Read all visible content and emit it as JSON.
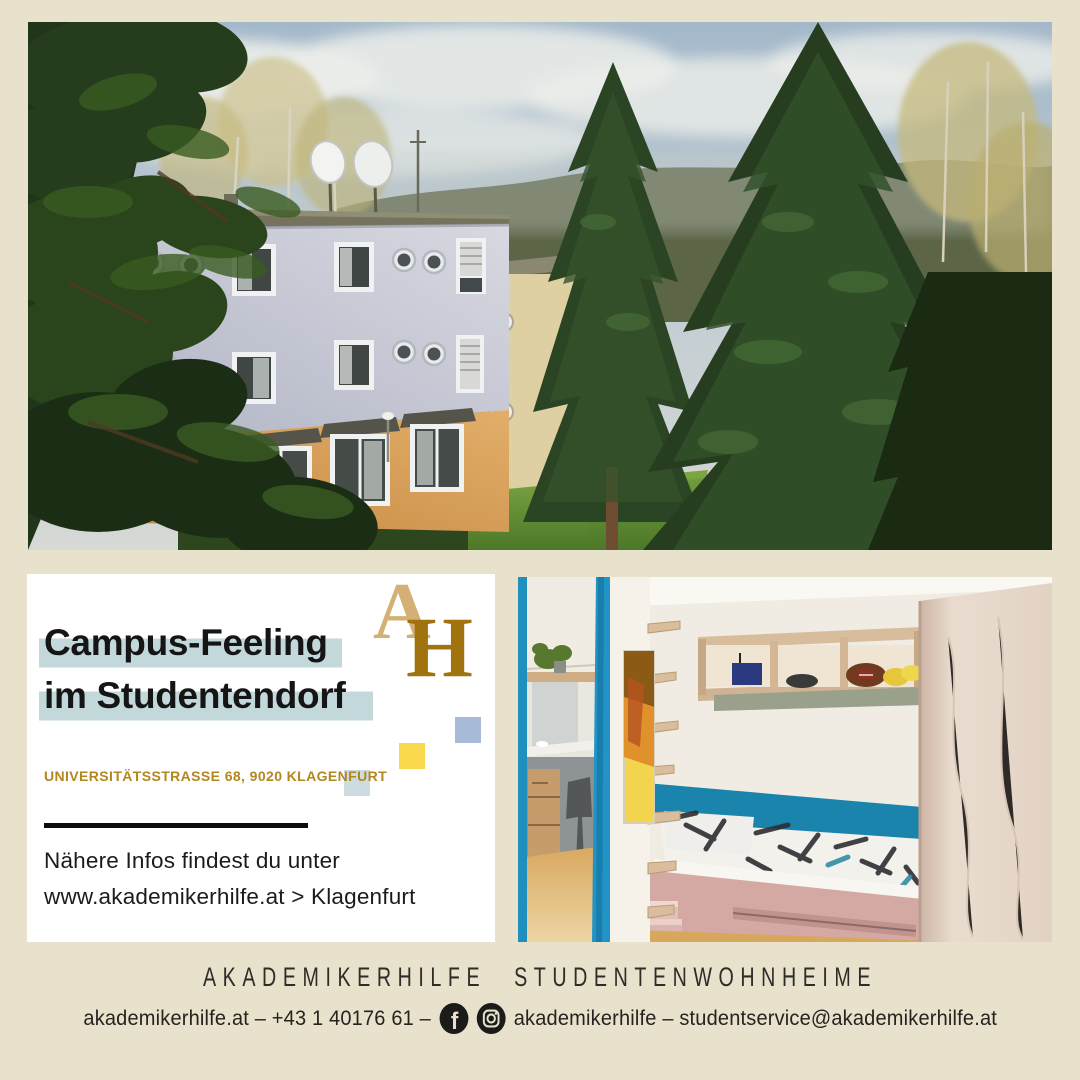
{
  "canvas": {
    "background_color": "#e8e1cc"
  },
  "top_photo": {
    "description": "Student dorm building with light grey upper floors, orange ground floor, round porthole windows, satellite dishes on roof, dark pine branches left, tall spruce trees right, lawn and wooded hill behind"
  },
  "card": {
    "headline_line1": "Campus-Feeling",
    "headline_line2": "im Studentendorf",
    "highlight_color": "#c3d8da",
    "address": "UNIVERSITÄTSSTRASSE 68, 9020 KLAGENFURT",
    "address_color": "#b3861f",
    "info_line1": "Nähere Infos findest du unter",
    "info_line2": "www.akademikerhilfe.at > Klagenfurt",
    "logo": {
      "letter_a": "A",
      "letter_h": "H",
      "color_a": "#d4b077",
      "color_h": "#a0730e"
    },
    "deco_squares": [
      {
        "name": "blue-square",
        "color": "#a7bbd9"
      },
      {
        "name": "yellow-square",
        "color": "#fbd94e"
      },
      {
        "name": "gray-blue-square",
        "color": "#cddce0"
      }
    ]
  },
  "room_photo": {
    "description": "Dorm room with bed and black-and-white patterned duvet, teal wall stripe, wooden wall shelf with bowls and football, tall wardrobe, artwork and mirrored view of desk area"
  },
  "footer": {
    "brand_word1": "AKADEMIKERHILFE",
    "brand_word2": "STUDENTENWOHNHEIME",
    "contact_left": "akademikerhilfe.at – +43 1 40176 61 –",
    "contact_right": "akademikerhilfe – studentservice@akademikerhilfe.at",
    "facebook_glyph": "f",
    "icons": [
      {
        "name": "facebook-icon"
      },
      {
        "name": "instagram-icon"
      }
    ]
  }
}
